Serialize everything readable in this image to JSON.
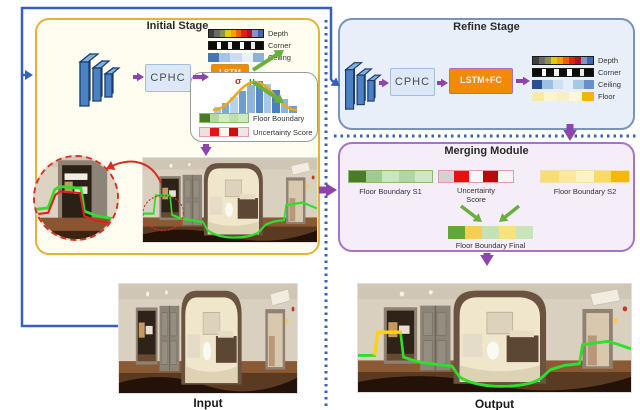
{
  "colors": {
    "accent_blue": "#3860b8",
    "accent_purple": "#8e44ad",
    "accent_green": "#6aaf3d",
    "accent_red": "#d83020",
    "accent_orange": "#f28a05",
    "initial_border": "#e2b33c",
    "refine_border": "#7a93b8",
    "merging_border": "#a674c4"
  },
  "initial_stage": {
    "title": "Initial Stage",
    "cphc_label": "CPHC",
    "lstm_line1": "LSTM",
    "lstm_line2": "+FC",
    "strips": {
      "depth": {
        "label": "Depth",
        "cells": [
          "#3f3f3f",
          "#6a6a6a",
          "#8f8f4a",
          "#e0d000",
          "#f5a000",
          "#f06000",
          "#e02010",
          "#b01030",
          "#8890c8",
          "#4066b0"
        ]
      },
      "corner": {
        "label": "Corner",
        "cells": [
          {
            "c": "#0c0c0c",
            "f": 2
          },
          {
            "c": "#ffffff",
            "f": 1
          },
          {
            "c": "#0c0c0c",
            "f": 2
          },
          {
            "c": "#f0f0f0",
            "f": 1
          },
          {
            "c": "#0c0c0c",
            "f": 2
          },
          {
            "c": "#ffffff",
            "f": 1
          },
          {
            "c": "#0c0c0c",
            "f": 2
          },
          {
            "c": "#e8e8e8",
            "f": 1
          },
          {
            "c": "#0c0c0c",
            "f": 2
          }
        ]
      },
      "ceiling": {
        "label": "Ceiling",
        "cells": [
          "#4a74b8",
          "#a6c4e4",
          "#cddcf0",
          "#e9f0f8",
          "#8cb0da"
        ]
      }
    },
    "gaussian": {
      "sigma": "σ",
      "mu": "μ",
      "histogram": [
        {
          "h": 0.18,
          "c": "#a9c7e8"
        },
        {
          "h": 0.32,
          "c": "#7fa8d4"
        },
        {
          "h": 0.5,
          "c": "#b9d2ec"
        },
        {
          "h": 0.68,
          "c": "#6f9cd0"
        },
        {
          "h": 0.86,
          "c": "#8fb4dc"
        },
        {
          "h": 1.0,
          "c": "#5588c4"
        },
        {
          "h": 0.92,
          "c": "#a9c7e8"
        },
        {
          "h": 0.72,
          "c": "#4a7fc1"
        },
        {
          "h": 0.45,
          "c": "#8fb4dc"
        },
        {
          "h": 0.22,
          "c": "#6f9cd0"
        }
      ],
      "floor_boundary": {
        "label": "Floor Boundary",
        "cells": [
          "#4a7c28",
          "#b4d8a0",
          "#d4eac4",
          "#bfe0ae",
          "#cfe8c0"
        ]
      },
      "uncertainty": {
        "label": "Uncertainty Score",
        "cells": [
          "#f0e0e0",
          "#e81414",
          "#faf6f6",
          "#cc0f0f",
          "#f0e6e6"
        ]
      }
    }
  },
  "refine_stage": {
    "title": "Refine Stage",
    "cphc_label": "CPHC",
    "lstm_label": "LSTM+FC",
    "strips": {
      "depth": {
        "label": "Depth",
        "cells": [
          "#3f3f3f",
          "#6a6a6a",
          "#8f8f4a",
          "#e0d000",
          "#f5a000",
          "#f06000",
          "#e02010",
          "#b01030",
          "#8890c8",
          "#4066b0"
        ]
      },
      "corner": {
        "label": "Corner",
        "cells": [
          {
            "c": "#0c0c0c",
            "f": 2
          },
          {
            "c": "#ffffff",
            "f": 1
          },
          {
            "c": "#0c0c0c",
            "f": 2
          },
          {
            "c": "#f0f0f0",
            "f": 1
          },
          {
            "c": "#0c0c0c",
            "f": 2
          },
          {
            "c": "#ffffff",
            "f": 1
          },
          {
            "c": "#0c0c0c",
            "f": 2
          },
          {
            "c": "#e8e8e8",
            "f": 1
          },
          {
            "c": "#0c0c0c",
            "f": 2
          }
        ]
      },
      "ceiling": {
        "label": "Ceiling",
        "cells": [
          "#2a4f8f",
          "#9cc0e4",
          "#cfe0f0",
          "#e6eef8",
          "#a8c6e6",
          "#6890c8"
        ]
      },
      "floor": {
        "label": "Floor",
        "cells": [
          "#f7e9a8",
          "#fcf4cc",
          "#f9efc0",
          "#fdf7dc",
          "#f2b606"
        ]
      }
    }
  },
  "merging_module": {
    "title": "Merging Module",
    "s1": {
      "label": "Floor Boundary S1",
      "cells": [
        "#4a7c28",
        "#a2cc8e",
        "#cce6bc",
        "#b2d6a2",
        "#cfe8c2"
      ]
    },
    "uncertainty": {
      "label_line1": "Uncertainty",
      "label_line2": "Score",
      "cells": [
        "#d2d2d2",
        "#ea1010",
        "#f8f6f6",
        "#b80c0c",
        "#f8f4f4"
      ]
    },
    "s2": {
      "label": "Floor Boundary S2",
      "cells": [
        "#f8dc74",
        "#fbe89e",
        "#fdf2c4",
        "#f8da66",
        "#f5b70a"
      ]
    },
    "final": {
      "label": "Floor Boundary Final",
      "cells": [
        "#62a838",
        "#f5d050",
        "#c4e2b4",
        "#f8e27c",
        "#c8e4b8"
      ]
    }
  },
  "captions": {
    "input": "Input",
    "output": "Output"
  }
}
